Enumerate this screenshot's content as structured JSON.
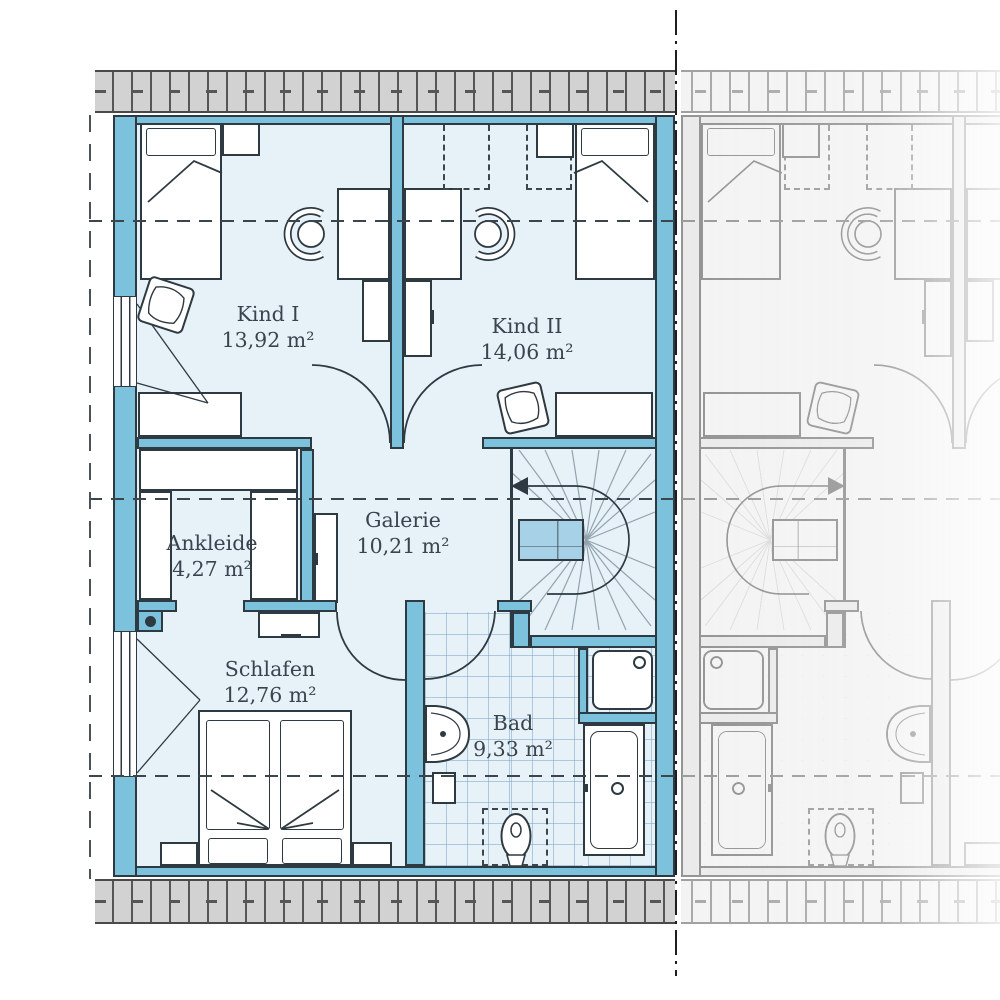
{
  "plan": {
    "rooms": [
      {
        "name": "Kind I",
        "area": "13,92 m²"
      },
      {
        "name": "Kind II",
        "area": "14,06 m²"
      },
      {
        "name": "Ankleide",
        "area": "4,27 m²"
      },
      {
        "name": "Galerie",
        "area": "10,21 m²"
      },
      {
        "name": "Schlafen",
        "area": "12,76 m²"
      },
      {
        "name": "Bad",
        "area": "9,33 m²"
      }
    ],
    "icons": {
      "stair_direction": "left-arrow"
    },
    "colors": {
      "wall_fill": "#7dc2dc",
      "floor_fill": "#e6f1f8",
      "outline": "#2e3a41",
      "stair_landing_fill": "#a7d1e7",
      "roof_hatch_fill": "#d2d2d2",
      "bath_tile_line": "#7da5c8",
      "label_text": "#39444c"
    }
  }
}
